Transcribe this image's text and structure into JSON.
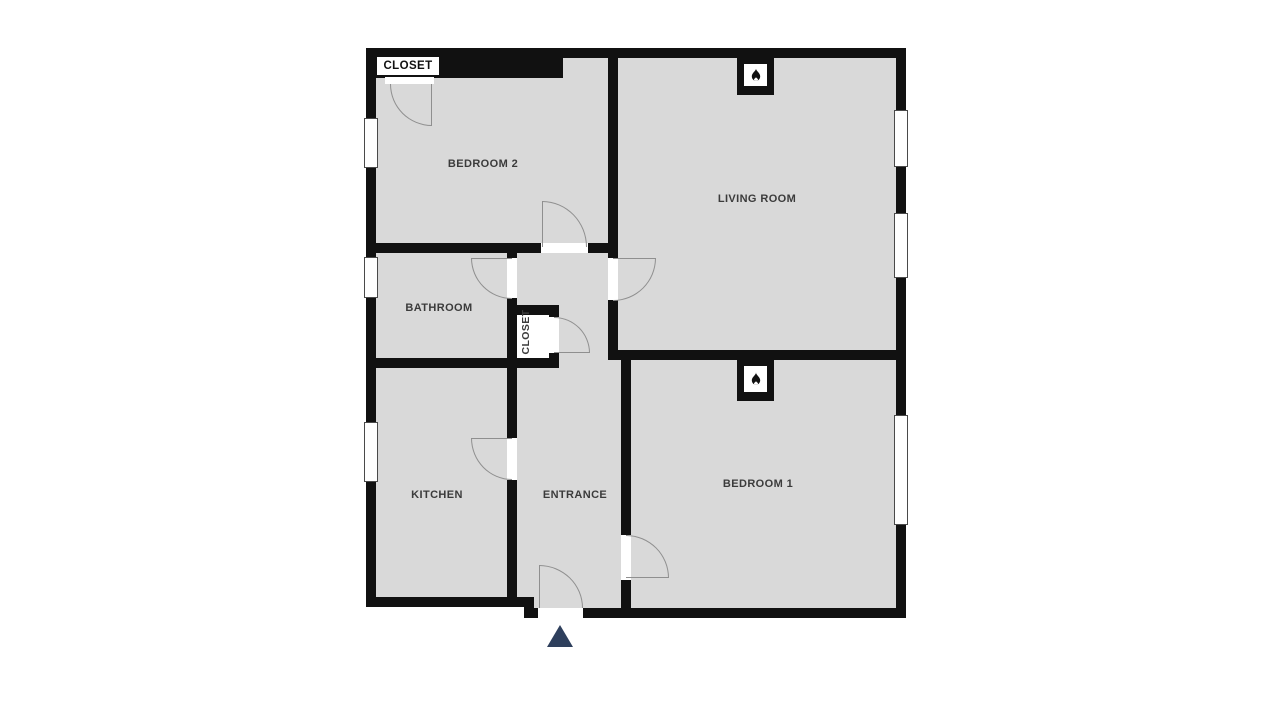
{
  "title": "Apartment floor plan",
  "rooms": {
    "bedroom2": "BEDROOM 2",
    "livingRoom": "LIVING ROOM",
    "bathroom": "BATHROOM",
    "hallCloset": "CLOSET",
    "kitchen": "KITCHEN",
    "entrance": "ENTRANCE",
    "bedroom1": "BEDROOM 1",
    "bedroomCloset": "CLOSET"
  },
  "icons": {
    "fireplace": "flame-icon",
    "entrance_marker": "triangle-up"
  },
  "counts": {
    "fireplaces": 2,
    "windows": 6,
    "door_swings": 8
  },
  "colors": {
    "wall": "#111111",
    "room_fill": "#d9d9d9",
    "background": "#ffffff",
    "door_arc": "#8f8f8f",
    "entrance_arrow": "#2e3f5c"
  }
}
